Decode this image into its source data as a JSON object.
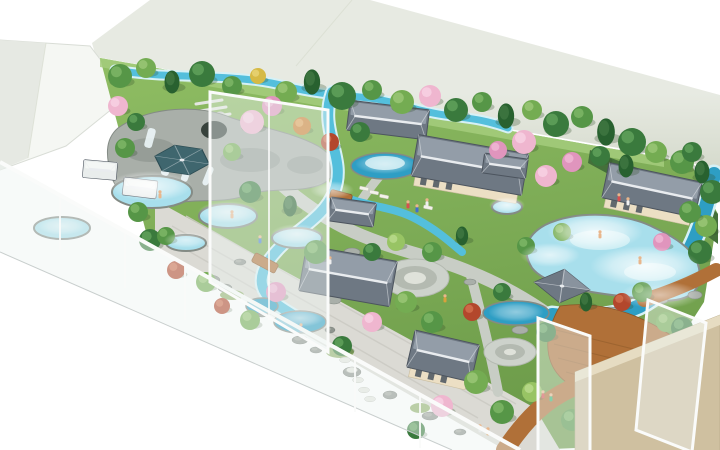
{
  "scene": {
    "title": "Aerial 3D rendering of a hot-spring garden spa resort",
    "style": "architectural-visualization"
  },
  "palette": {
    "background": "#ffffff",
    "back_wall": "#e7eae2",
    "back_wall_dark": "#d5dacc",
    "white_wall": "#f5f7f3",
    "white_wall_edge": "#d9ddd6",
    "white_wall_shade": "#e6e9e3",
    "glass": "#eef3f2",
    "glass_frame": "#fafbfa",
    "glass_edge": "#c8cecd",
    "tan_wall": "#cfc0a0",
    "tan_wall_edge": "#b5a786",
    "tan_wall_top": "#e6dcc2",
    "grass_light": "#a5cc7d",
    "grass_light2": "#8fbd63",
    "grass_dark": "#6d9c4a",
    "hedge": "#44703a",
    "water": "#54bfdc",
    "water_deep": "#2e9ec4",
    "pool_fill": "#a8dfec",
    "pool_light": "#d6f1f6",
    "cascade": "#eef8fa",
    "rock": "#a9afa9",
    "rock_dark": "#848b85",
    "stone_dark": "#8f948e",
    "stone_hi": "#a6aba4",
    "cave": "#37423c",
    "path": "#c8cdc5",
    "path_dark": "#b4bab1",
    "path_light": "#e3e6e0",
    "plaza": "#cdd2cb",
    "plaza_light": "#dfe2da",
    "gravel": "#dbdad4",
    "gravel_line": "#cbcac3",
    "moss": "#86a95c",
    "stepstone": "#e6e7e1",
    "wood": "#b07038",
    "wood_dark": "#8a5526",
    "deck_line": "#96602e",
    "roof_base": "#6e7883",
    "roof_light": "#a0aab4",
    "roof_dark": "#4c545e",
    "ridge": "#e9ecef",
    "roof_white": "#e9edec",
    "roof_white_hi": "#f7f9f8",
    "teal_roof": "#3f666e",
    "teal_roof_dark": "#2d4d54",
    "cream": "#ecdfc4",
    "cream_edge": "#c9bd9f",
    "door_glass": "#49545e",
    "skin": "#e9b68c",
    "lounger": "#f3f2ea",
    "tree_shadow": "#2f4d28"
  },
  "tree_colors": {
    "g1": [
      "#3a7a3d",
      "#63a45c"
    ],
    "g2": [
      "#569647",
      "#7fb868"
    ],
    "g3": [
      "#74ac52",
      "#9cc878"
    ],
    "pine": [
      "#28612f",
      "#477f49"
    ],
    "lg": [
      "#98c464",
      "#bcdc8f"
    ],
    "pink": [
      "#efb6cf",
      "#f8d3e3"
    ],
    "pink2": [
      "#e095bd",
      "#f0b9d6"
    ],
    "red": [
      "#b3472c",
      "#d3704f"
    ],
    "orange": [
      "#cd7e2f",
      "#e6a85c"
    ],
    "yellow": [
      "#d6ba45",
      "#e9d477"
    ]
  },
  "trees": [
    [
      120,
      76,
      "g2",
      12
    ],
    [
      146,
      68,
      "g3",
      10
    ],
    [
      172,
      82,
      "pine",
      11
    ],
    [
      202,
      74,
      "g1",
      13
    ],
    [
      232,
      86,
      "g2",
      10
    ],
    [
      258,
      76,
      "yellow",
      8
    ],
    [
      286,
      92,
      "g3",
      11
    ],
    [
      312,
      82,
      "pine",
      12
    ],
    [
      342,
      96,
      "g1",
      14
    ],
    [
      372,
      90,
      "g2",
      10
    ],
    [
      402,
      102,
      "g3",
      12
    ],
    [
      430,
      96,
      "pink",
      11
    ],
    [
      456,
      110,
      "g1",
      12
    ],
    [
      482,
      102,
      "g2",
      10
    ],
    [
      506,
      116,
      "pine",
      12
    ],
    [
      532,
      110,
      "g3",
      10
    ],
    [
      556,
      124,
      "g1",
      13
    ],
    [
      582,
      117,
      "g2",
      11
    ],
    [
      606,
      132,
      "pine",
      13
    ],
    [
      632,
      142,
      "g1",
      14
    ],
    [
      656,
      152,
      "g3",
      11
    ],
    [
      682,
      162,
      "g2",
      12
    ],
    [
      702,
      172,
      "pine",
      11
    ],
    [
      712,
      192,
      "g1",
      12
    ],
    [
      706,
      226,
      "g3",
      11
    ],
    [
      692,
      152,
      "g1",
      10
    ],
    [
      118,
      106,
      "pink",
      10
    ],
    [
      136,
      122,
      "g1",
      9
    ],
    [
      125,
      148,
      "g2",
      10
    ],
    [
      252,
      122,
      "pink",
      12
    ],
    [
      272,
      106,
      "pink2",
      10
    ],
    [
      302,
      126,
      "orange",
      9
    ],
    [
      330,
      142,
      "red",
      9
    ],
    [
      360,
      132,
      "g1",
      10
    ],
    [
      232,
      152,
      "g3",
      9
    ],
    [
      138,
      212,
      "g2",
      10
    ],
    [
      150,
      240,
      "g1",
      11
    ],
    [
      176,
      270,
      "red",
      9
    ],
    [
      206,
      282,
      "g3",
      10
    ],
    [
      166,
      236,
      "g2",
      9
    ],
    [
      250,
      192,
      "g1",
      11
    ],
    [
      290,
      206,
      "pine",
      10
    ],
    [
      316,
      252,
      "g2",
      12
    ],
    [
      276,
      292,
      "pink2",
      10
    ],
    [
      250,
      320,
      "g3",
      10
    ],
    [
      222,
      306,
      "red",
      8
    ],
    [
      372,
      252,
      "g1",
      9
    ],
    [
      396,
      242,
      "lg",
      9
    ],
    [
      432,
      252,
      "g2",
      10
    ],
    [
      462,
      236,
      "pine",
      9
    ],
    [
      406,
      302,
      "g3",
      11
    ],
    [
      372,
      322,
      "pink",
      10
    ],
    [
      342,
      346,
      "g1",
      10
    ],
    [
      432,
      322,
      "g2",
      11
    ],
    [
      472,
      312,
      "red",
      9
    ],
    [
      502,
      292,
      "g1",
      9
    ],
    [
      476,
      382,
      "g3",
      12
    ],
    [
      442,
      406,
      "pink",
      11
    ],
    [
      502,
      412,
      "g2",
      12
    ],
    [
      532,
      392,
      "lg",
      10
    ],
    [
      416,
      430,
      "g1",
      9
    ],
    [
      546,
      176,
      "pink",
      11
    ],
    [
      572,
      162,
      "pink2",
      10
    ],
    [
      600,
      156,
      "g1",
      10
    ],
    [
      626,
      166,
      "pine",
      11
    ],
    [
      690,
      212,
      "g2",
      11
    ],
    [
      700,
      252,
      "g1",
      12
    ],
    [
      662,
      242,
      "pink2",
      9
    ],
    [
      562,
      232,
      "g3",
      9
    ],
    [
      526,
      246,
      "g2",
      9
    ],
    [
      546,
      332,
      "g1",
      10
    ],
    [
      586,
      302,
      "pine",
      9
    ],
    [
      622,
      302,
      "red",
      9
    ],
    [
      642,
      292,
      "g2",
      10
    ],
    [
      666,
      322,
      "g3",
      10
    ],
    [
      682,
      328,
      "g1",
      11
    ],
    [
      572,
      420,
      "g2",
      11
    ],
    [
      600,
      430,
      "pink",
      10
    ],
    [
      630,
      416,
      "g1",
      12
    ],
    [
      640,
      393,
      "g3",
      10
    ],
    [
      680,
      370,
      "lg",
      9
    ],
    [
      612,
      372,
      "orange",
      8
    ],
    [
      524,
      142,
      "pink",
      12
    ],
    [
      498,
      150,
      "pink2",
      9
    ]
  ],
  "buildings": [
    {
      "t": "hip",
      "x": 388,
      "y": 120,
      "w": 80,
      "h": 30,
      "r": 7,
      "wall": false
    },
    {
      "t": "hip",
      "x": 470,
      "y": 165,
      "w": 112,
      "h": 42,
      "r": 10,
      "wall": true
    },
    {
      "t": "hip",
      "x": 652,
      "y": 190,
      "w": 95,
      "h": 36,
      "r": 12,
      "wall": true
    },
    {
      "t": "hip",
      "x": 352,
      "y": 212,
      "w": 46,
      "h": 24,
      "r": 8,
      "wall": false
    },
    {
      "t": "hip",
      "x": 348,
      "y": 276,
      "w": 92,
      "h": 46,
      "r": 10,
      "wall": false
    },
    {
      "t": "hip",
      "x": 443,
      "y": 356,
      "w": 66,
      "h": 38,
      "r": 13,
      "wall": true
    },
    {
      "t": "hip",
      "x": 505,
      "y": 166,
      "w": 44,
      "h": 20,
      "r": 8,
      "wall": false
    },
    {
      "t": "hipw",
      "x": 100,
      "y": 170,
      "w": 34,
      "h": 18,
      "r": 5,
      "wall": false
    },
    {
      "t": "hipw",
      "x": 140,
      "y": 188,
      "w": 34,
      "h": 18,
      "r": 7,
      "wall": false
    },
    {
      "t": "pyr",
      "x": 562,
      "y": 286,
      "w": 40,
      "r": 8
    },
    {
      "t": "hex",
      "x": 182,
      "y": 160,
      "w": 56
    }
  ],
  "steam": [
    [
      150,
      186,
      42,
      15,
      0.8
    ],
    [
      228,
      212,
      30,
      11,
      0.7
    ],
    [
      297,
      234,
      26,
      10,
      0.7
    ],
    [
      186,
      240,
      22,
      8,
      0.6
    ],
    [
      595,
      232,
      48,
      18,
      0.85
    ],
    [
      645,
      266,
      55,
      20,
      0.85
    ],
    [
      550,
      255,
      30,
      12,
      0.7
    ],
    [
      507,
      205,
      18,
      8,
      0.8
    ],
    [
      385,
      164,
      30,
      10,
      0.5
    ],
    [
      332,
      190,
      22,
      9,
      0.6
    ],
    [
      300,
      318,
      24,
      9,
      0.6
    ],
    [
      516,
      312,
      28,
      10,
      0.5
    ],
    [
      62,
      226,
      24,
      9,
      0.6
    ],
    [
      660,
      295,
      40,
      14,
      0.6
    ]
  ],
  "people": [
    [
      408,
      206,
      "#d94f4f"
    ],
    [
      417,
      210,
      "#3f6fd0"
    ],
    [
      427,
      204,
      "#eeeeee"
    ],
    [
      619,
      199,
      "#d94f4f"
    ],
    [
      628,
      203,
      "#f2f2f2"
    ],
    [
      543,
      396,
      "#d94f4f"
    ],
    [
      551,
      399,
      "#2fb573"
    ],
    [
      480,
      430,
      "#e8e8e8"
    ],
    [
      488,
      433,
      "#d98a3b"
    ],
    [
      301,
      329,
      "#e06a9b"
    ],
    [
      260,
      241,
      "#4a7fd4"
    ],
    [
      160,
      196,
      "#e9b68c"
    ],
    [
      232,
      216,
      "#e9b68c"
    ],
    [
      640,
      262,
      "#e9b68c"
    ],
    [
      600,
      236,
      "#e9b68c"
    ],
    [
      330,
      262,
      "#efefef"
    ],
    [
      445,
      300,
      "#d9a13b"
    ]
  ],
  "gravel_rocks": [
    [
      210,
      280,
      10,
      5
    ],
    [
      225,
      288,
      7,
      4
    ],
    [
      262,
      312,
      9,
      5
    ],
    [
      300,
      340,
      8,
      4
    ],
    [
      316,
      350,
      6,
      3
    ],
    [
      352,
      372,
      9,
      5
    ],
    [
      390,
      395,
      7,
      4
    ],
    [
      430,
      416,
      8,
      4
    ],
    [
      460,
      432,
      6,
      3
    ],
    [
      240,
      262,
      6,
      3
    ],
    [
      275,
      295,
      5,
      3
    ],
    [
      330,
      330,
      5,
      3
    ]
  ],
  "gravel_moss": [
    [
      232,
      295,
      12,
      5
    ],
    [
      340,
      352,
      14,
      6
    ],
    [
      420,
      408,
      10,
      5
    ]
  ],
  "stepping_stones": [
    [
      345,
      360
    ],
    [
      352,
      370
    ],
    [
      358,
      380
    ],
    [
      364,
      390
    ],
    [
      370,
      399
    ]
  ],
  "scatter_rocks": [
    [
      352,
      252,
      8,
      4
    ],
    [
      334,
      300,
      7,
      4
    ],
    [
      520,
      330,
      8,
      4
    ],
    [
      560,
      345,
      7,
      4
    ],
    [
      610,
      312,
      9,
      5
    ],
    [
      470,
      282,
      6,
      3
    ],
    [
      660,
      300,
      8,
      4
    ],
    [
      695,
      295,
      7,
      4
    ]
  ],
  "loungers": [
    [
      360,
      186
    ],
    [
      370,
      190
    ],
    [
      380,
      194
    ],
    [
      424,
      205
    ]
  ]
}
